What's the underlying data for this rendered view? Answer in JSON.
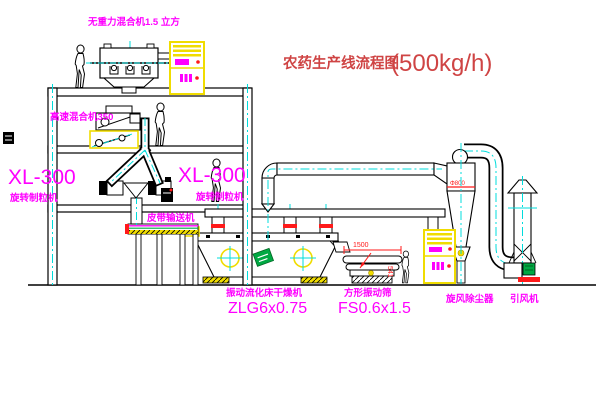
{
  "title": {
    "name": "农药生产线流程图",
    "capacity": "(500kg/h)"
  },
  "labels": {
    "gravity_mixer": "无重力混合机1.5 立方",
    "high_speed_mixer": "高速混合机350",
    "granulator_left_model": "XL-300",
    "granulator_left_name": "旋转制粒机",
    "granulator_mid_model": "XL-300",
    "granulator_mid_name": "旋转制粒机",
    "belt_conveyor": "皮带输送机",
    "dryer_name": "振动流化床干燥机",
    "dryer_model": "ZLG6x0.75",
    "sieve_name": "方形振动筛",
    "sieve_model": "FS0.6x1.5",
    "cyclone_name": "旋风除尘器",
    "fan_name": "引风机"
  },
  "dimensions": {
    "sieve_width": "1500",
    "sieve_height": "541",
    "cyclone_note": "Φ800"
  },
  "colors": {
    "label_magenta": "#ff00ff",
    "title_red": "#cf4444",
    "equipment_yellow": "#f0dc00",
    "centerline_cyan": "#00dcdc",
    "accent_red": "#ff1a1a",
    "motor_green": "#00a843",
    "line_black": "#000000",
    "background": "#ffffff"
  }
}
